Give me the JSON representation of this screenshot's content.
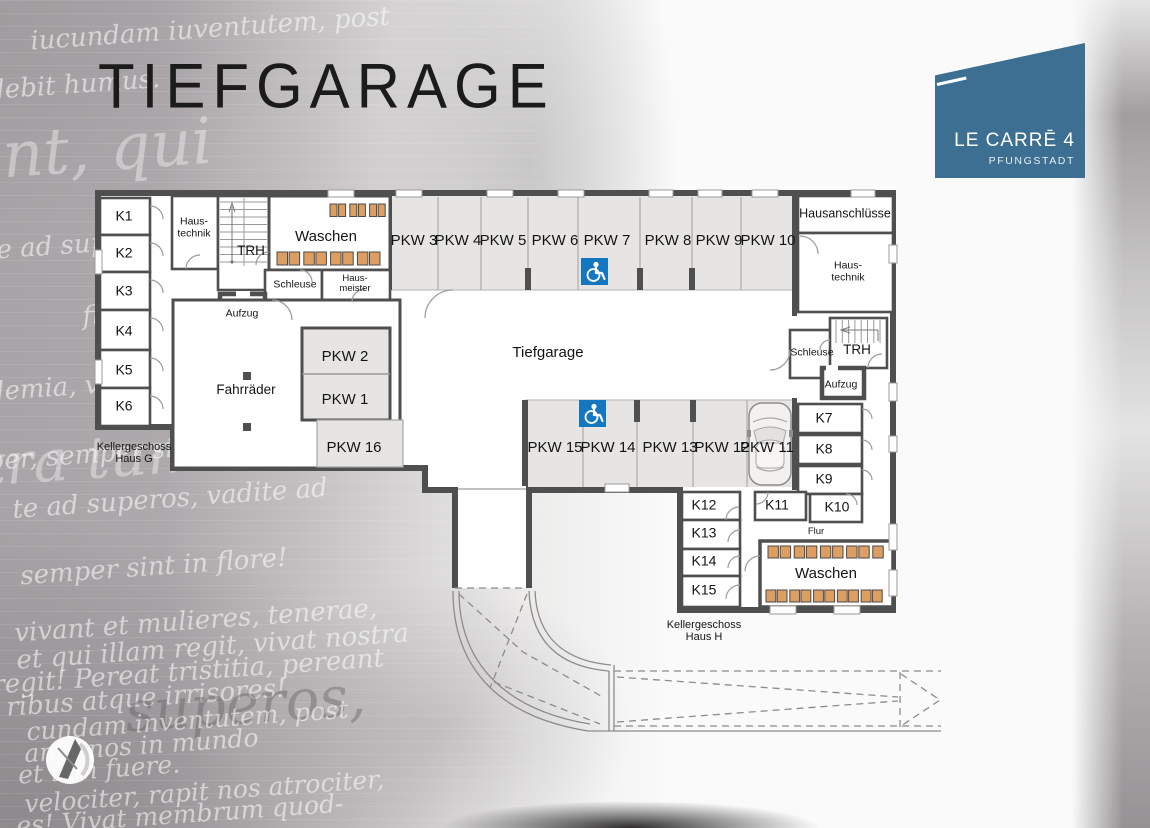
{
  "title": "TIEFGARAGE",
  "logo": {
    "name": "LE CARRĒ 4",
    "city": "PFUNGSTADT"
  },
  "colors": {
    "logo_blue": "#3d6f92",
    "handicap_blue": "#1577c0",
    "machine_orange": "#dd9e62",
    "wall_grey": "#4f4f4f",
    "parking_grey": "#e6e5e3"
  },
  "garage_label": "Tiefgarage",
  "captions": {
    "haus_g_line1": "Kellergeschoss",
    "haus_g_line2": "Haus G",
    "haus_h_line1": "Kellergeschoss",
    "haus_h_line2": "Haus H"
  },
  "rooms": {
    "haustechnik_left_line1": "Haus-",
    "haustechnik_left_line2": "technik",
    "trh_left": "TRH",
    "waschen_top": "Waschen",
    "schleuse_left": "Schleuse",
    "hausmeister_line1": "Haus-",
    "hausmeister_line2": "meister",
    "aufzug_left": "Aufzug",
    "fahrraeder": "Fahrräder",
    "hausanschluesse": "Hausanschlüsse",
    "haustechnik_right_line1": "Haus-",
    "haustechnik_right_line2": "technik",
    "trh_right": "TRH",
    "schleuse_right": "Schleuse",
    "aufzug_right": "Aufzug",
    "flur": "Flur",
    "waschen_bottom": "Waschen"
  },
  "storage": {
    "k1": "K1",
    "k2": "K2",
    "k3": "K3",
    "k4": "K4",
    "k5": "K5",
    "k6": "K6",
    "k7": "K7",
    "k8": "K8",
    "k9": "K9",
    "k10": "K10",
    "k11": "K11",
    "k12": "K12",
    "k13": "K13",
    "k14": "K14",
    "k15": "K15"
  },
  "parking": {
    "pkw1": "PKW 1",
    "pkw2": "PKW 2",
    "pkw3": "PKW 3",
    "pkw4": "PKW 4",
    "pkw5": "PKW 5",
    "pkw6": "PKW 6",
    "pkw7": "PKW 7",
    "pkw8": "PKW 8",
    "pkw9": "PKW 9",
    "pkw10": "PKW 10",
    "pkw11": "PKW 11",
    "pkw12": "PKW 12",
    "pkw13": "PKW 13",
    "pkw14": "PKW 14",
    "pkw15": "PKW 15",
    "pkw16": "PKW 16"
  },
  "machines": {
    "waschen_top": {
      "row1": 6,
      "row2": 8
    },
    "waschen_bottom": {
      "row1": 9,
      "row2": 10
    }
  },
  "icons": {
    "wheelchair": "wheelchair-icon",
    "car": "car-top-view-icon",
    "washing_machine": "washing-machine-icon",
    "stairs": "stairs-icon",
    "compass": "compass-logo-icon"
  },
  "background_text": [
    "iucundam iuventutem, post",
    "debit humus.",
    "aite ad superos, vadite ad",
    "finietur. Venit mors veloc-",
    "ademia, vivant professores!",
    "aber, semper sint in flore!",
    "nt, qui",
    "tra tum",
    "te ad superos, vadite ad",
    "semper sint in flore!",
    "vivant et mulieres, tenerae,",
    "et qui illam regit, vivat nostra",
    "regit! Pereat tristitia, pereant",
    "ribus atque irrisores!",
    "cundam inventutem, post",
    "ante nos in mundo",
    "et iam fuere.",
    "velociter, rapit nos atrociter,",
    "es! Vivat membrum quod-",
    "superos,"
  ]
}
